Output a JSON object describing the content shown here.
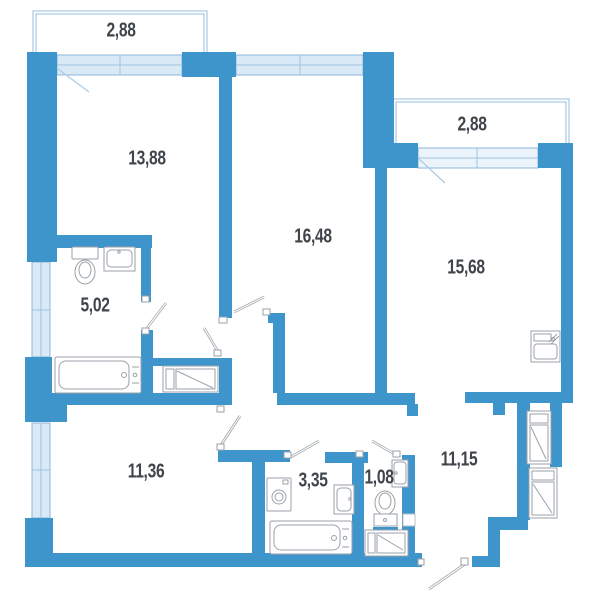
{
  "plan": {
    "labels": {
      "balcony_top": "2,88",
      "room_13_88": "13,88",
      "balcony_right": "2,88",
      "room_16_48": "16,48",
      "room_15_68": "15,68",
      "bathroom_5_02": "5,02",
      "room_11_36": "11,36",
      "bathroom_3_35": "3,35",
      "wc_1_08": "1,08",
      "hallway_11_15": "11,15"
    },
    "colors": {
      "wall": "#3d95cb",
      "window_fill": "#d9e9f6",
      "window_frame": "#8cb6d9",
      "balcony_outline": "#aecce3",
      "fixture_outline": "#9aa2a8",
      "label_text": "#3f454b",
      "background": "#ffffff"
    }
  }
}
